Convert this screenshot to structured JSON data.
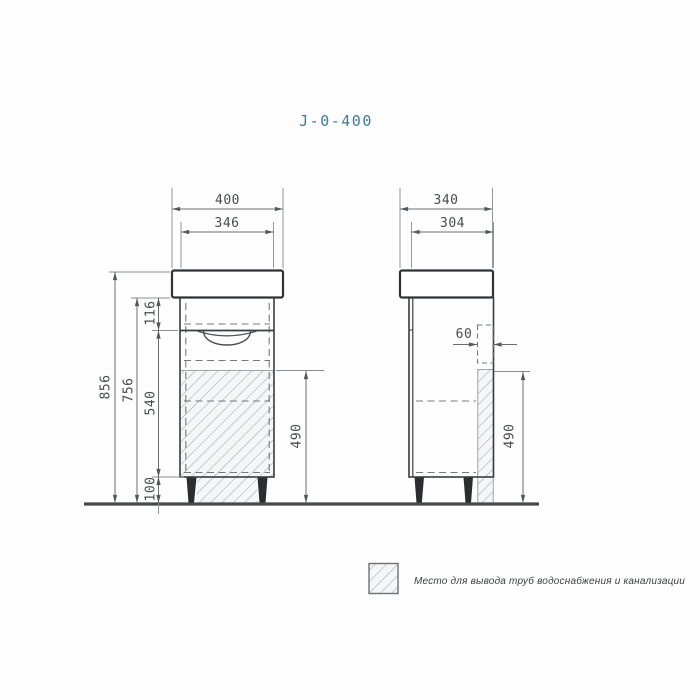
{
  "title": "J-0-400",
  "colors": {
    "background": "#fdfdfd",
    "title_accent": "#3f7b92",
    "main_line": "#313335",
    "dimension_line": "#6b6e71",
    "dashed_line": "#75797c",
    "hatch_line": "#a9aeb2",
    "leg_fill": "#2b2d2f",
    "floor_line": "#47494b"
  },
  "front_view": {
    "label": "front-view-of-vanity-cabinet",
    "dims": {
      "top_width": "400",
      "inner_width": "346",
      "total_height": "856",
      "body_height": "756",
      "drawer_height": "116",
      "lower_height": "540",
      "leg_height": "100",
      "clearance_height": "490"
    }
  },
  "side_view": {
    "label": "side-view-of-vanity-cabinet",
    "dims": {
      "top_depth": "340",
      "inner_depth": "304",
      "back_gap": "60",
      "clearance_height": "490"
    }
  },
  "legend": {
    "swatch": "hatch-swatch",
    "text": "Место для вывода труб водоснабжения и канализации"
  }
}
